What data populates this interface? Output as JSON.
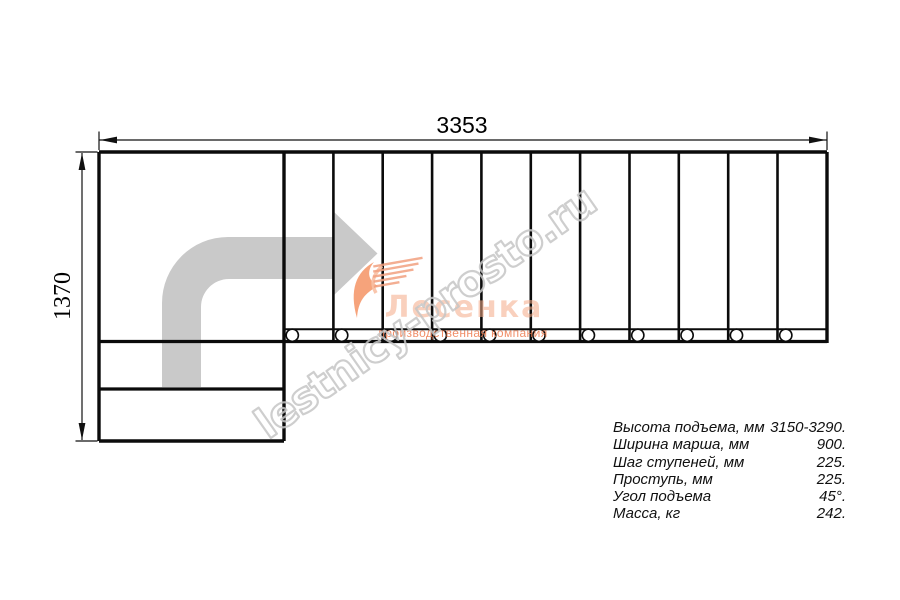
{
  "diagram": {
    "width_label": "3353",
    "height_label": "1370",
    "tread_count": 11,
    "baluster_count": 11
  },
  "watermark": {
    "site": "lestnicy-prosto.ru"
  },
  "logo": {
    "title": "Лесенка",
    "tagline": "производственная компания"
  },
  "specs": {
    "rows": [
      {
        "label": "Высота подъема, мм",
        "value": "3150-3290."
      },
      {
        "label": "Ширина марша, мм",
        "value": "900."
      },
      {
        "label": "Шаг ступеней, мм",
        "value": "225."
      },
      {
        "label": "Проступь, мм",
        "value": "225."
      },
      {
        "label": "Угол подъема",
        "value": "45°."
      },
      {
        "label": "Масса, кг",
        "value": "242."
      }
    ]
  },
  "colors": {
    "line": "#0b0b0b",
    "arrow_fill": "#c9c9c9",
    "watermark_stroke": "#c6c6c6",
    "logo_primary": "#f5ab88",
    "logo_accent": "#ee7b4e"
  }
}
